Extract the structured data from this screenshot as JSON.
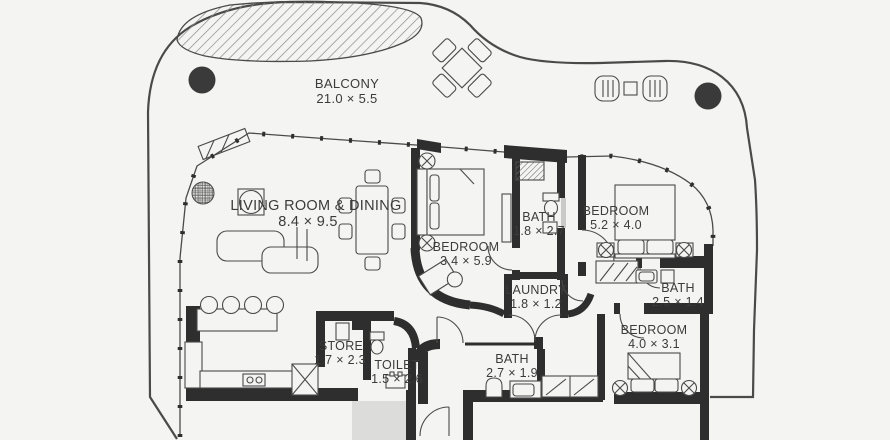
{
  "palette": {
    "background": "#f4f4f2",
    "wall": "#2e2e2e",
    "line": "#4a4a4a",
    "text": "#3b3b3b",
    "hatch": "#8b8b89",
    "gray_area": "#dcdcda"
  },
  "rooms": [
    {
      "id": "balcony",
      "name": "BALCONY",
      "dims": "21.0 × 5.5"
    },
    {
      "id": "living-dining",
      "name": "LIVING ROOM & DINING",
      "dims": "8.4 × 9.5"
    },
    {
      "id": "bedroom-1",
      "name": "BEDROOM",
      "dims": "3.4 × 5.9"
    },
    {
      "id": "bath-1",
      "name": "BATH",
      "dims": "1.8 × 2.7"
    },
    {
      "id": "bedroom-2",
      "name": "BEDROOM",
      "dims": "5.2 × 4.0"
    },
    {
      "id": "bath-2",
      "name": "BATH",
      "dims": "2.5 × 1.4"
    },
    {
      "id": "laundry",
      "name": "LAUNDRY",
      "dims": "1.8 × 1.2"
    },
    {
      "id": "bedroom-3",
      "name": "BEDROOM",
      "dims": "4.0 × 3.1"
    },
    {
      "id": "store",
      "name": "STORE",
      "dims": "1.7 × 2.3"
    },
    {
      "id": "toilet",
      "name": "TOILET",
      "dims": "1.5 × 2.6"
    },
    {
      "id": "bath-3",
      "name": "BATH",
      "dims": "2.7 × 1.9"
    }
  ]
}
